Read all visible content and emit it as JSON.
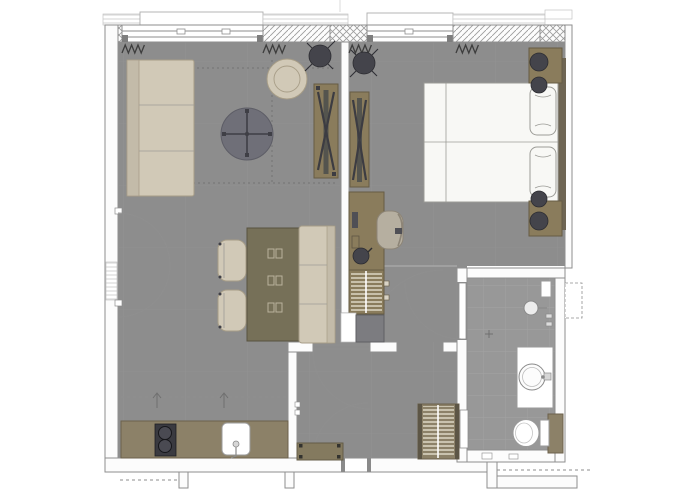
{
  "document": {
    "type": "architectural-floor-plan",
    "view": "top-down",
    "text_labels": []
  },
  "palette": {
    "paper": "#ffffff",
    "floor": "#8d8d8d",
    "floor_bath": "#989898",
    "tile_line": "#a6a6a6",
    "wall_fill": "#fcfcfc",
    "wall_line": "#8e8e8e",
    "hatch_line": "#9c9c9c",
    "beige": "#d1c9b7",
    "beige_dark": "#a79d87",
    "olive": "#8a7c5c",
    "olive_dark": "#665c44",
    "table_olive": "#767058",
    "table_olive_dark": "#58523f",
    "counter": "#8c8168",
    "counter_dark": "#6b614c",
    "white_furn": "#f8f8f5",
    "furn_line": "#9c9c97",
    "dark_fixture": "#44444b",
    "dark_stroke": "#2c2c31",
    "mid_gray": "#6f6f78",
    "arc_line": "#8f8f8f",
    "stripe_cream": "#eae4d4",
    "bench_gray": "#7c7c80",
    "headboard": "#6e6553",
    "chair_gray": "#b6afa0"
  },
  "symbols": [
    "window",
    "window-sill",
    "masonry-cross-hatch",
    "concrete-diagonal-hatch",
    "radiator-zigzag-icon",
    "door-swing-arc",
    "pendant-light-icon",
    "tv-mount-x-icon",
    "wardrobe-hanging-rail",
    "cooktop-burners",
    "kitchen-sink",
    "shower-head",
    "washbasin",
    "toilet",
    "floor-drain-cross"
  ],
  "rooms": [
    {
      "name": "living-room",
      "furniture": [
        "sofa",
        "coffee-table",
        "armchair",
        "side-table",
        "media-panel"
      ]
    },
    {
      "name": "dining-area",
      "furniture": [
        "dining-table",
        "dining-chair",
        "dining-chair",
        "dining-bench"
      ]
    },
    {
      "name": "kitchenette",
      "furniture": [
        "counter",
        "cooktop",
        "sink",
        "upper-cabinets-dashed"
      ]
    },
    {
      "name": "bedroom",
      "furniture": [
        "double-bed",
        "pillow",
        "pillow",
        "headboard",
        "nightstand",
        "nightstand",
        "table-lamp",
        "table-lamp",
        "media-panel",
        "desk",
        "desk-chair",
        "wardrobe",
        "luggage-bench",
        "pendant-light"
      ]
    },
    {
      "name": "hallway",
      "furniture": [
        "entry-bench",
        "coat-wardrobe",
        "entry-door"
      ]
    },
    {
      "name": "bathroom",
      "fixtures": [
        "shower",
        "vanity-washbasin",
        "toilet",
        "towel-shelf"
      ]
    }
  ]
}
